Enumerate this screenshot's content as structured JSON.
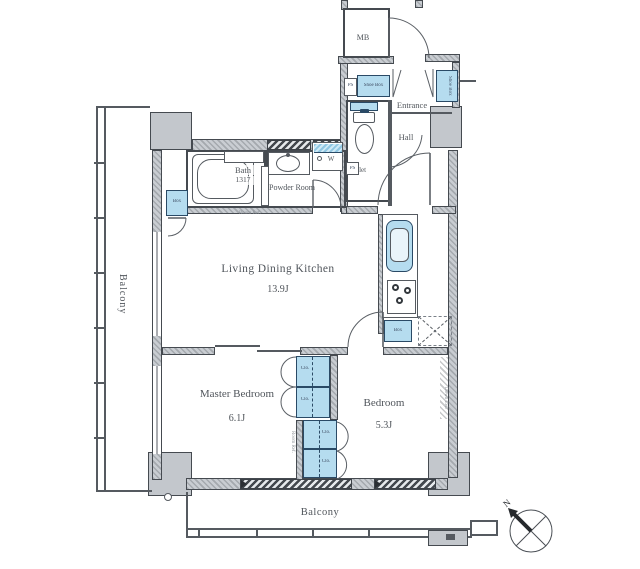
{
  "rooms": {
    "ldk": {
      "name": "Living Dining Kitchen",
      "area": "13.9J"
    },
    "master_bedroom": {
      "name": "Master Bedroom",
      "area": "6.1J"
    },
    "bedroom": {
      "name": "Bedroom",
      "area": "5.3J"
    },
    "bath": {
      "name": "Bath",
      "size": "1317"
    },
    "powder_room": {
      "name": "Powder Room"
    },
    "toilet": {
      "name": "Toilet"
    },
    "hall": {
      "name": "Hall"
    },
    "entrance": {
      "name": "Entrance"
    },
    "mb": {
      "name": "MB"
    },
    "balcony_left": {
      "name": "Balcony"
    },
    "balcony_bottom": {
      "name": "Balcony"
    }
  },
  "storage": {
    "shoe_box_top": "Shoe Box",
    "shoe_box_side": "Shoe Box",
    "closets": [
      "Clo.",
      "Clo.",
      "Clo.",
      "Clo."
    ],
    "box_left": "Box",
    "box_kitchen": "Box"
  },
  "utility": {
    "ps_top": "PS",
    "ps_mid": "PS",
    "washer": "W"
  },
  "notes": {
    "bath_note": "Room Ref.",
    "closet_note": "Room Ref.",
    "bedroom_note": "Down Ceil"
  },
  "compass": {
    "north": "N"
  },
  "colors": {
    "fixture_blue": "#b5dcef",
    "structure_gray": "#c9cdd2",
    "line_dark": "#454a50"
  }
}
